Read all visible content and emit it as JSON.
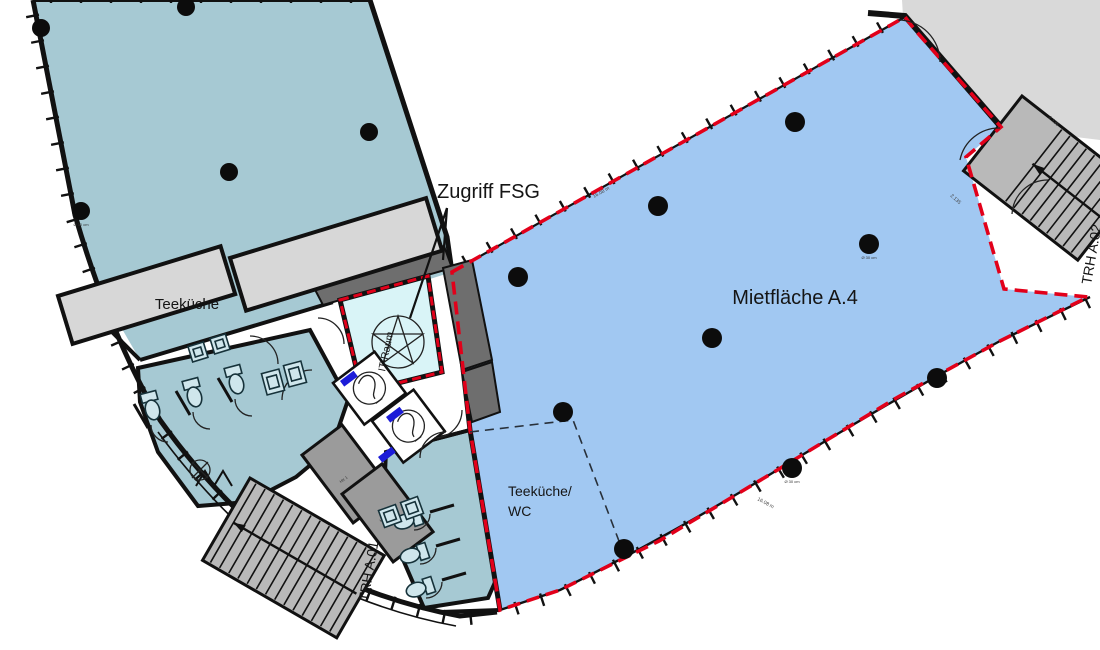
{
  "labels": {
    "access": "Zugriff FSG",
    "rental_area": "Mietfläche A.4",
    "kitchen": "Teeküche",
    "kitchen_wc_line1": "Teeküche/",
    "kitchen_wc_line2": "WC",
    "it_room": "IT-Raum",
    "stairwell_bottom": "TRH A.01",
    "stairwell_right": "TRH A.02"
  },
  "micro_labels": {
    "stair_door_note_1": "2.135",
    "stair_door_note_2": "2.135",
    "facade_note_1": "16.08 m",
    "facade_note_2": "16.08 m",
    "column_note_1": "Ø 30 cm",
    "column_note_2": "Ø 30 cm",
    "column_note_3": "Ø 30 cm",
    "shaft_note_1": "HK 1",
    "shaft_note_2": "HK 2"
  },
  "colors": {
    "left_wing_fill": "#a6c9d3",
    "rental_fill": "#a1c8f2",
    "it_room_fill": "#d9f4f7",
    "adjacent_gray": "#d9d9d9",
    "stair_gray": "#b9b9b9",
    "core_wall_gray": "#6e6e6e",
    "shaft_gray": "#9b9b9b",
    "counter_gray": "#d7d7d7",
    "boundary_red": "#e2001a",
    "door_marker_blue": "#1c1cd8"
  }
}
